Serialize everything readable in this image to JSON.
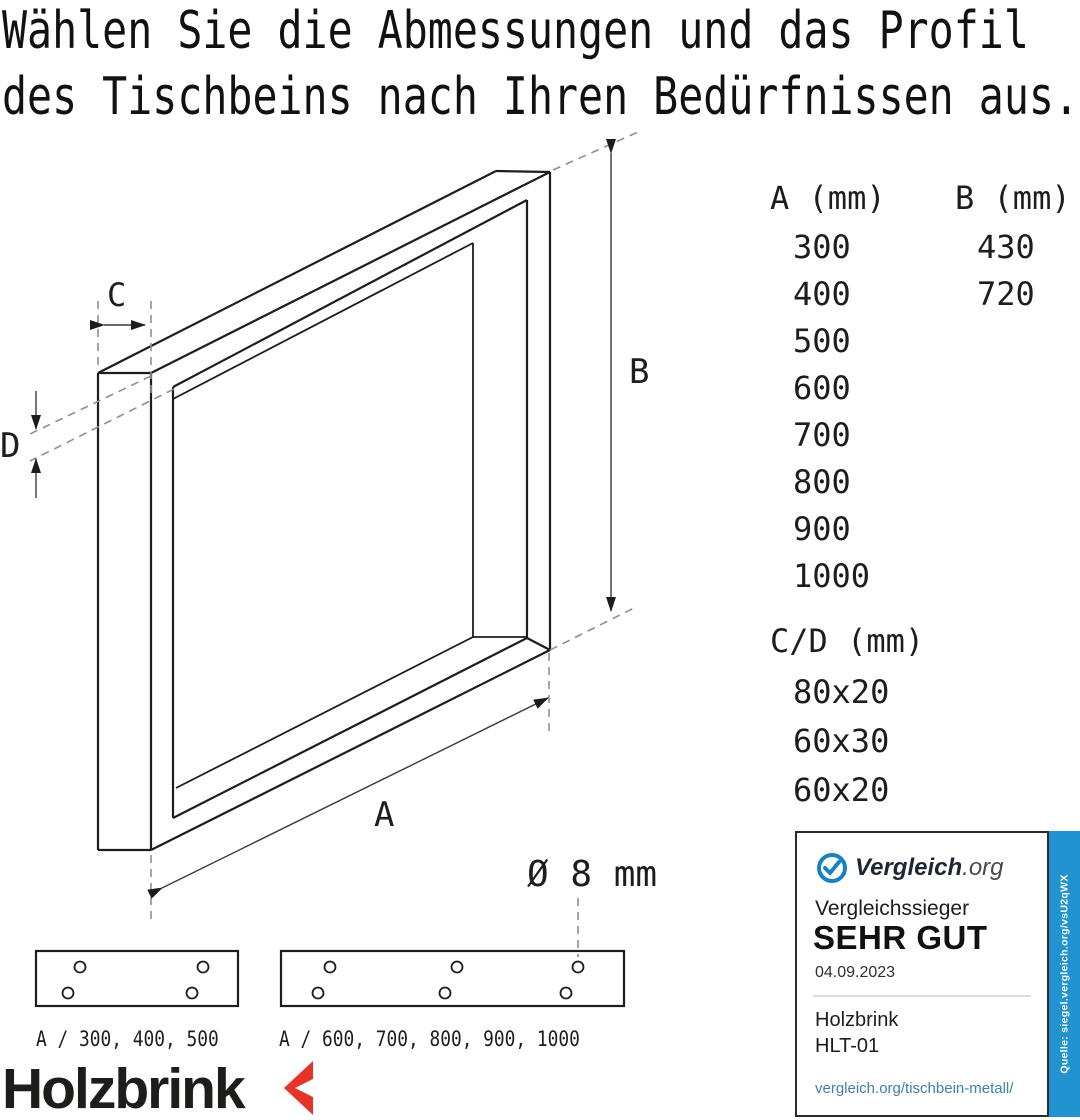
{
  "title": {
    "line1": "Wählen Sie die Abmessungen und das Profil",
    "line2": "des Tischbeins nach Ihren Bedürfnissen aus."
  },
  "dimensions": {
    "column_a": {
      "header": "A (mm)",
      "values": [
        "300",
        "400",
        "500",
        "600",
        "700",
        "800",
        "900",
        "1000"
      ]
    },
    "column_b": {
      "header": "B (mm)",
      "values": [
        "430",
        "720"
      ]
    },
    "column_cd": {
      "header": "C/D (mm)",
      "values": [
        "80x20",
        "60x30",
        "60x20"
      ]
    }
  },
  "drawing": {
    "label_a": "A",
    "label_b": "B",
    "label_c": "C",
    "label_d": "D",
    "hole_diameter": "Ø 8 mm"
  },
  "plates": {
    "small": {
      "label": "A / 300, 400, 500"
    },
    "large": {
      "label": "A / 600, 700, 800, 900, 1000"
    }
  },
  "badge": {
    "brand": "Vergleich",
    "brand_suffix": ".org",
    "award_type": "Vergleichssieger",
    "grade": "SEHR GUT",
    "date": "04.09.2023",
    "product_brand": "Holzbrink",
    "product_model": "HLT-01",
    "url": "vergleich.org/tischbein-metall/",
    "source_note": "Quelle: siegel.vergleich.org/vsU2qWX"
  },
  "brand_logo": {
    "text": "Holzbrink"
  },
  "colors": {
    "accent_blue": "#2193cf",
    "check_blue": "#1a80c4",
    "logo_red": "#e6332a",
    "link_blue": "#4080a8",
    "line": "#1d1d1d"
  }
}
